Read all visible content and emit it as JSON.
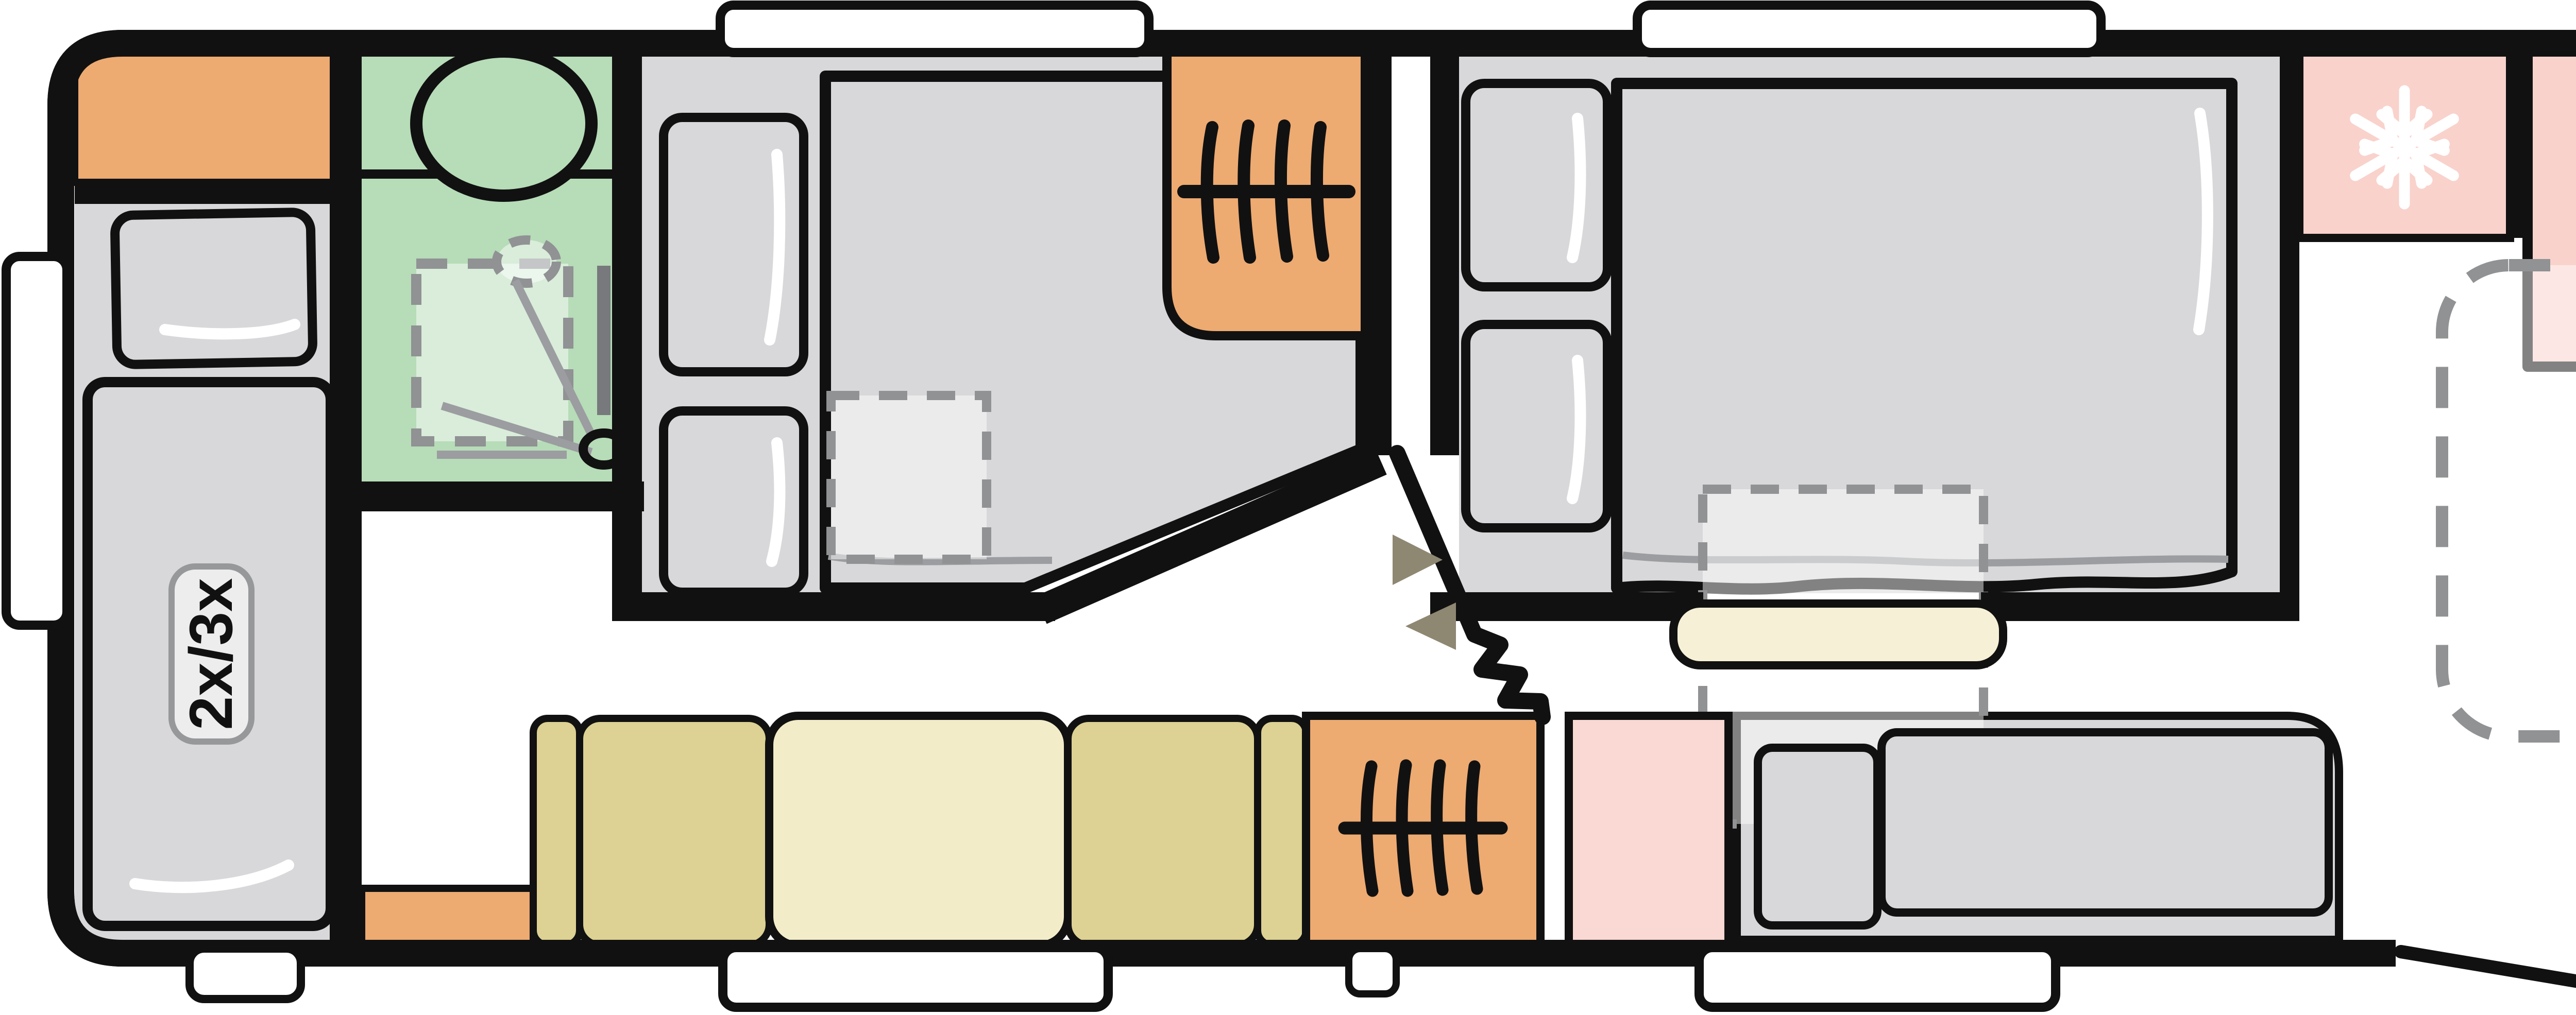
{
  "title": "Caravan floor plan",
  "labels": {
    "bunk_bed": "2x/3x"
  },
  "icons": [
    "hanging-rail-icon",
    "snowflake-icon",
    "hob-burner-icon",
    "sink-icon",
    "toilet-icon",
    "shower-icon",
    "sliding-door-icon",
    "door-swing-icon",
    "entrance-arrow-icon",
    "window-icon",
    "drop-down-bed-outline-icon",
    "fold-out-table-outline-icon"
  ],
  "colors": {
    "ink": "#111111",
    "orange": "#edaa71",
    "green": "#b7dcb8",
    "floor_gray": "#d8d8da",
    "khaki": "#ddd193",
    "cream": "#f2ecc9",
    "cream_step": "#f6f0d6",
    "pink": "#f9d2cc",
    "pink_light": "#fad8d3",
    "tan": "#ded5bc",
    "olive": "#8e8772",
    "dash_gray": "#909294",
    "line_gray": "#9b9da0",
    "box_gray": "#85888b",
    "label_fill": "#ededee",
    "label_stroke": "#97989a"
  }
}
